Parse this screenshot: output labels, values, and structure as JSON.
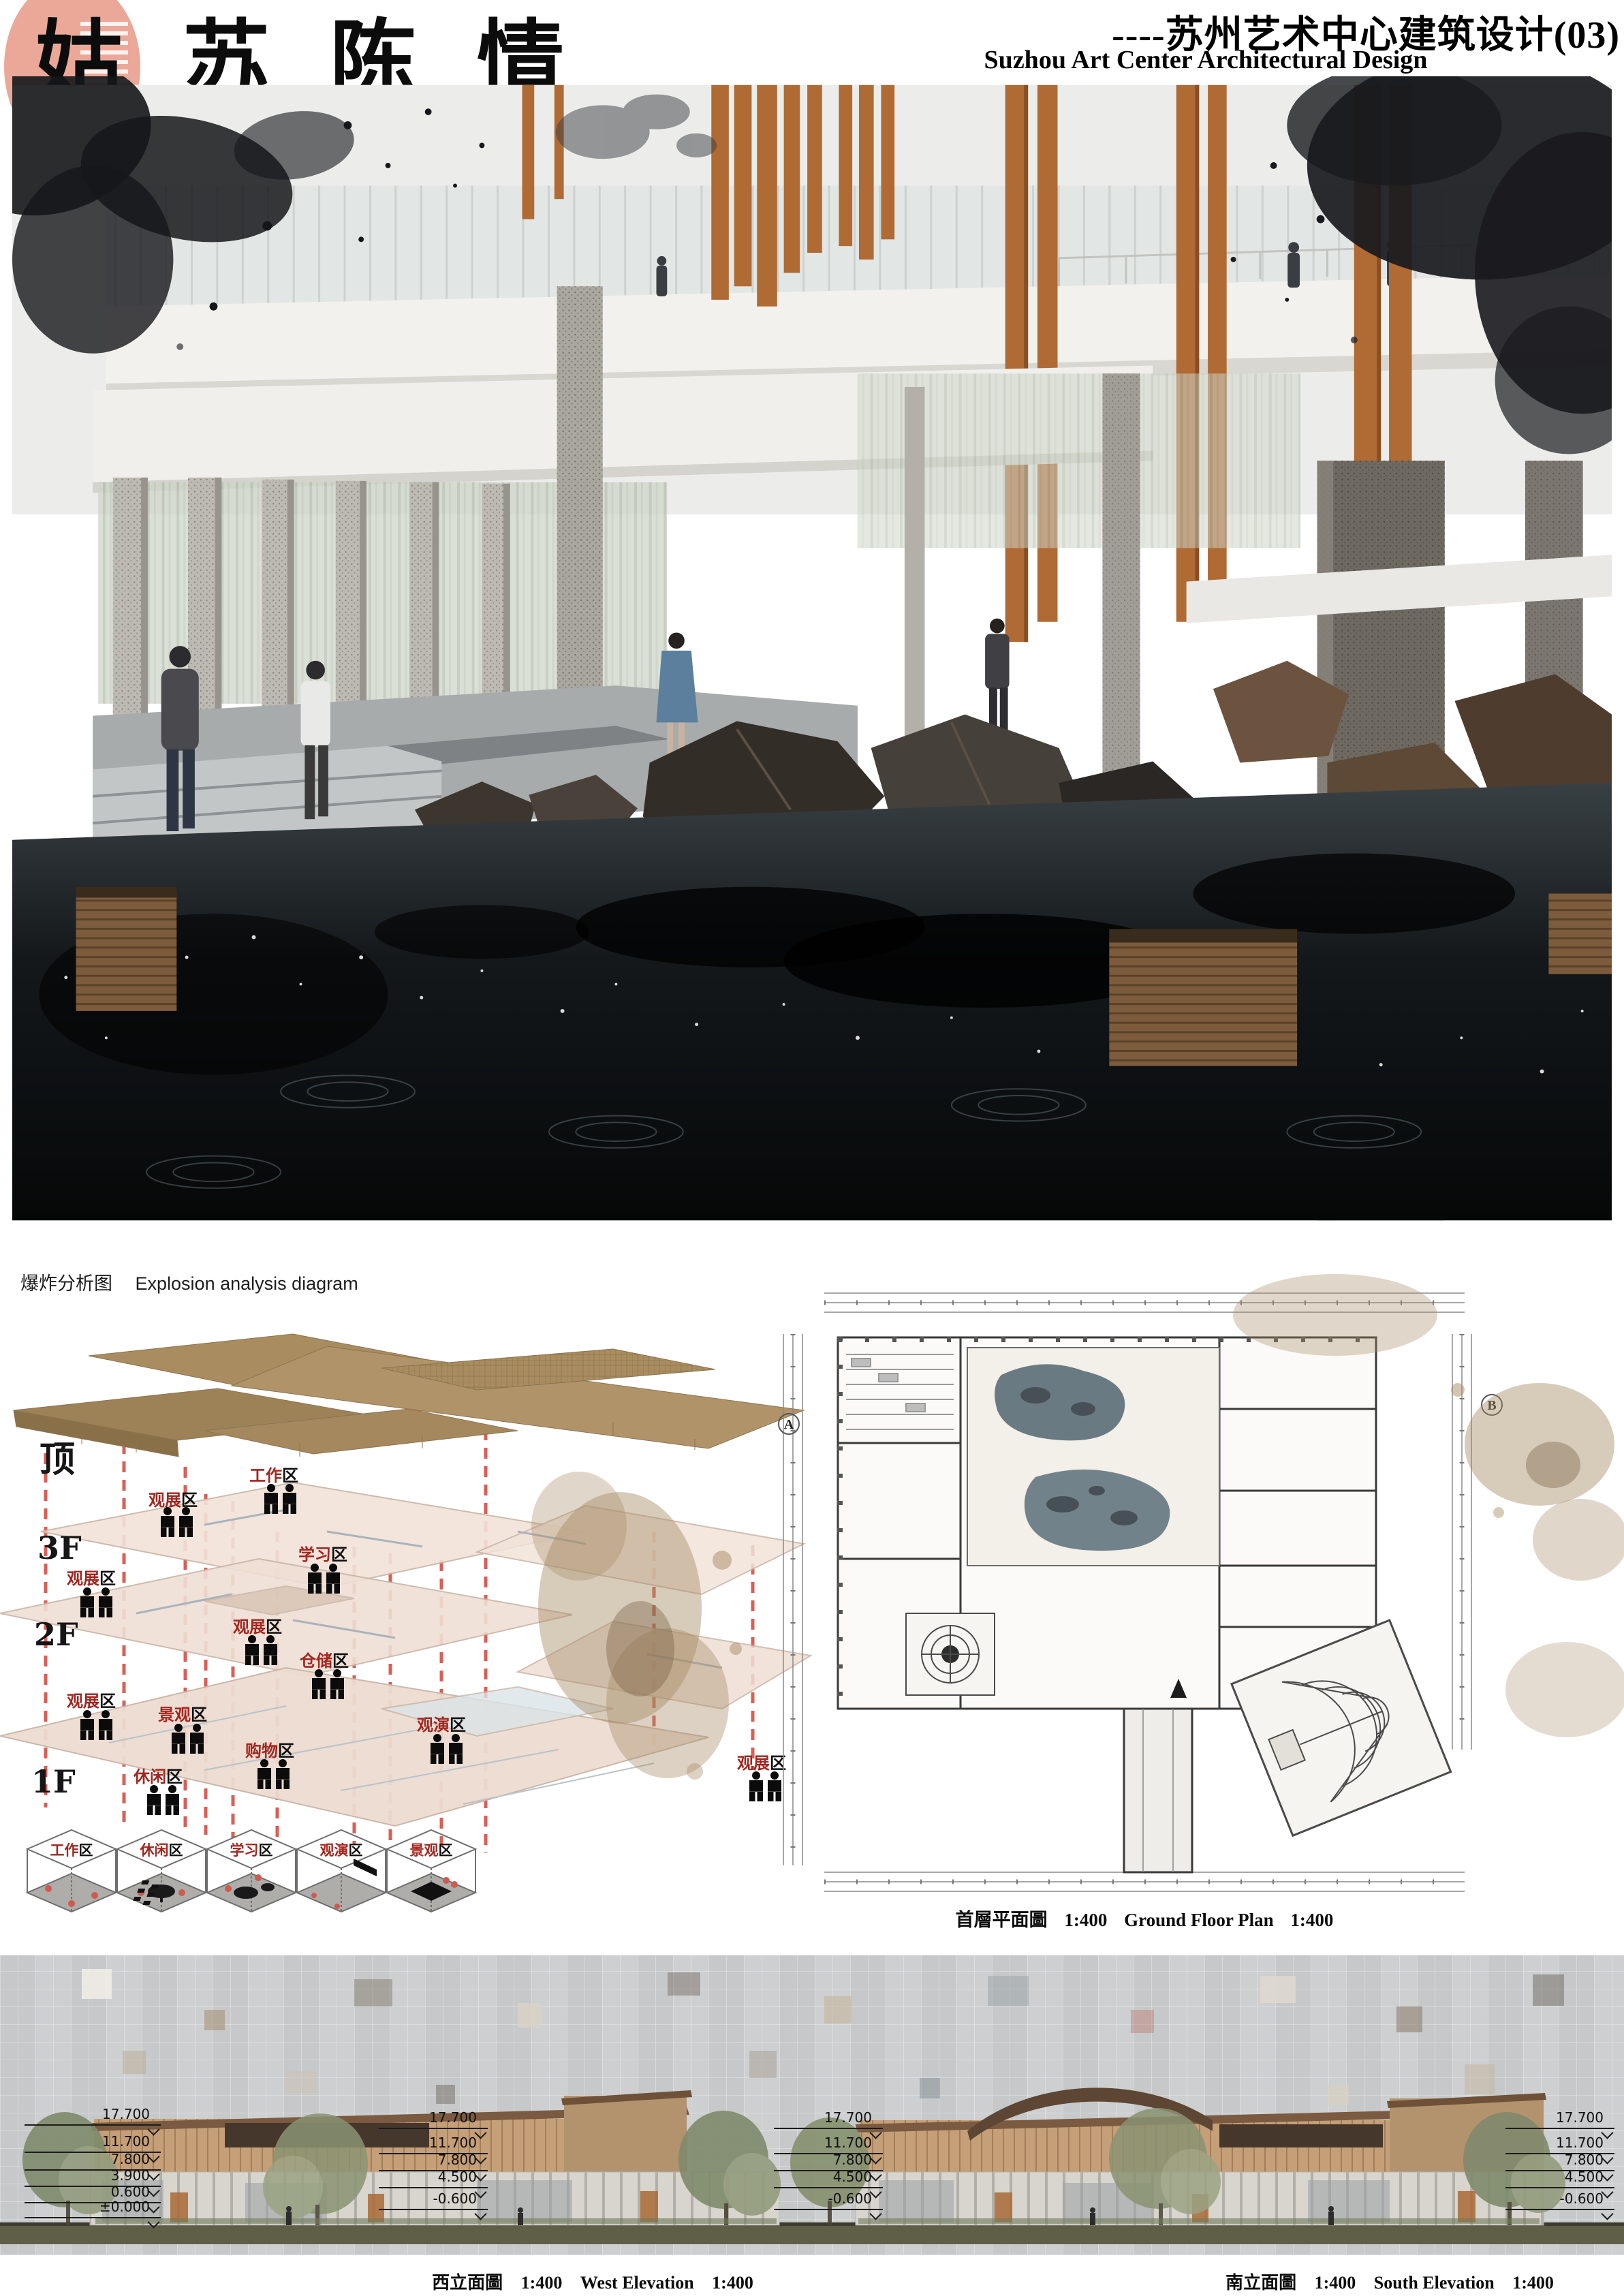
{
  "header": {
    "title_calligraphy": "姑苏陈情",
    "subtitle_cn": "----苏州艺术中心建筑设计(03)",
    "subtitle_en": "Suzhou Art Center Architectural Design"
  },
  "explosion": {
    "title_cn": "爆炸分析图",
    "title_en": "Explosion analysis diagram",
    "floors": [
      "顶",
      "3F",
      "2F",
      "1F"
    ],
    "zones": [
      {
        "name": "观展",
        "suffix": "区"
      },
      {
        "name": "工作",
        "suffix": "区"
      },
      {
        "name": "学习",
        "suffix": "区"
      },
      {
        "name": "观展",
        "suffix": "区"
      },
      {
        "name": "仓储",
        "suffix": "区"
      },
      {
        "name": "观展",
        "suffix": "区"
      },
      {
        "name": "观展",
        "suffix": "区"
      },
      {
        "name": "景观",
        "suffix": "区"
      },
      {
        "name": "休闲",
        "suffix": "区"
      },
      {
        "name": "购物",
        "suffix": "区"
      },
      {
        "name": "观演",
        "suffix": "区"
      },
      {
        "name": "观展",
        "suffix": "区"
      }
    ],
    "legend": [
      {
        "name": "工作",
        "suffix": "区"
      },
      {
        "name": "休闲",
        "suffix": "区"
      },
      {
        "name": "学习",
        "suffix": "区"
      },
      {
        "name": "观演",
        "suffix": "区"
      },
      {
        "name": "景观",
        "suffix": "区"
      }
    ]
  },
  "plan": {
    "caption_cn": "首層平面圖",
    "scale": "1:400",
    "caption_en": "Ground Floor Plan",
    "grid_labels": [
      "A",
      "B"
    ]
  },
  "elevations": {
    "west": {
      "caption_cn": "西立面圖",
      "scale": "1:400",
      "caption_en": "West Elevation"
    },
    "south": {
      "caption_cn": "南立面圖",
      "scale": "1:400",
      "caption_en": "South Elevation"
    },
    "levels_a": [
      "17.700",
      "11.700",
      "7.800",
      "3.900",
      "0.600",
      "±0.000"
    ],
    "levels_b": [
      "17.700",
      "11.700",
      "7.800",
      "4.500",
      "-0.600"
    ],
    "levels_c": [
      "17.700",
      "11.700",
      "7.800",
      "4.500",
      "-0.600"
    ],
    "levels_d": [
      "17.700",
      "11.700",
      "7.800",
      "4.500",
      "-0.600"
    ]
  },
  "colors": {
    "brush_pink": "#eba899",
    "ink_black": "#101114",
    "roof_tan": "#a3875c",
    "plate_pink": "#f0ddd2",
    "dash_red": "#d95f55",
    "zone_red": "#a3261f",
    "wood_orange": "#b06a33",
    "water_dark": "#0b0e10",
    "ground_olive": "#5f5f48"
  }
}
